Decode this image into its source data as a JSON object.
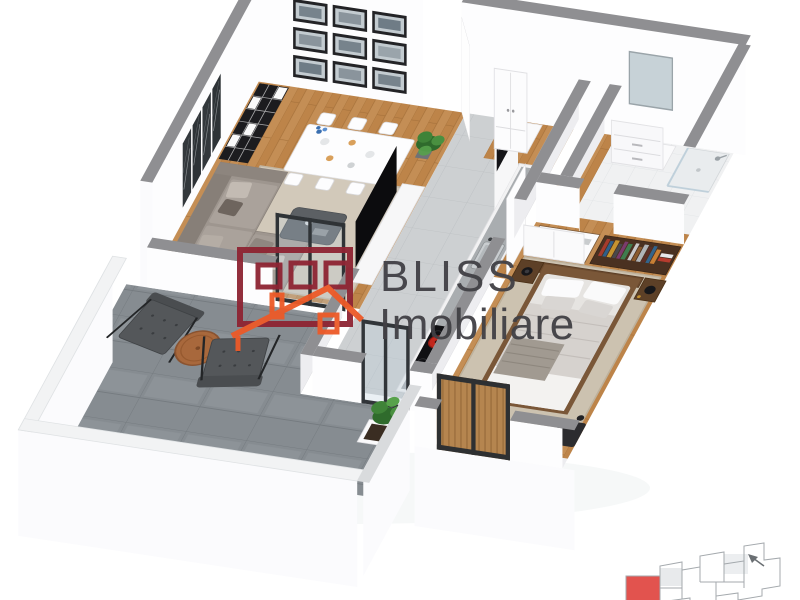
{
  "watermark": {
    "line1": "BLISS",
    "line2": "Imobiliare"
  },
  "palette": {
    "background": "#ffffff",
    "wall-top": "#8f8f92",
    "wall-face": "#fdfdfe",
    "wood-floor": "#c48e55",
    "wood-floor-line": "#a5713a",
    "kitchen-tile": "#cdd0d2",
    "bath-tile": "#f0f1f2",
    "terrace-stone": "#868c91",
    "rug-living": "#d2c9ba",
    "rug-bedroom": "#ccc2b0",
    "sofa": "#9e968f",
    "bed-duvet": "#d6d2ce",
    "accent-pot-red": "#c1271d",
    "plant-green": "#2f6b2c",
    "tv-black": "#0c0c0e",
    "logo-red": "#8e2433",
    "logo-orange": "#ed5a28",
    "logo-text": "#414045",
    "keyplan-red": "#e2534e",
    "keyplan-line": "#a4a9ad"
  }
}
